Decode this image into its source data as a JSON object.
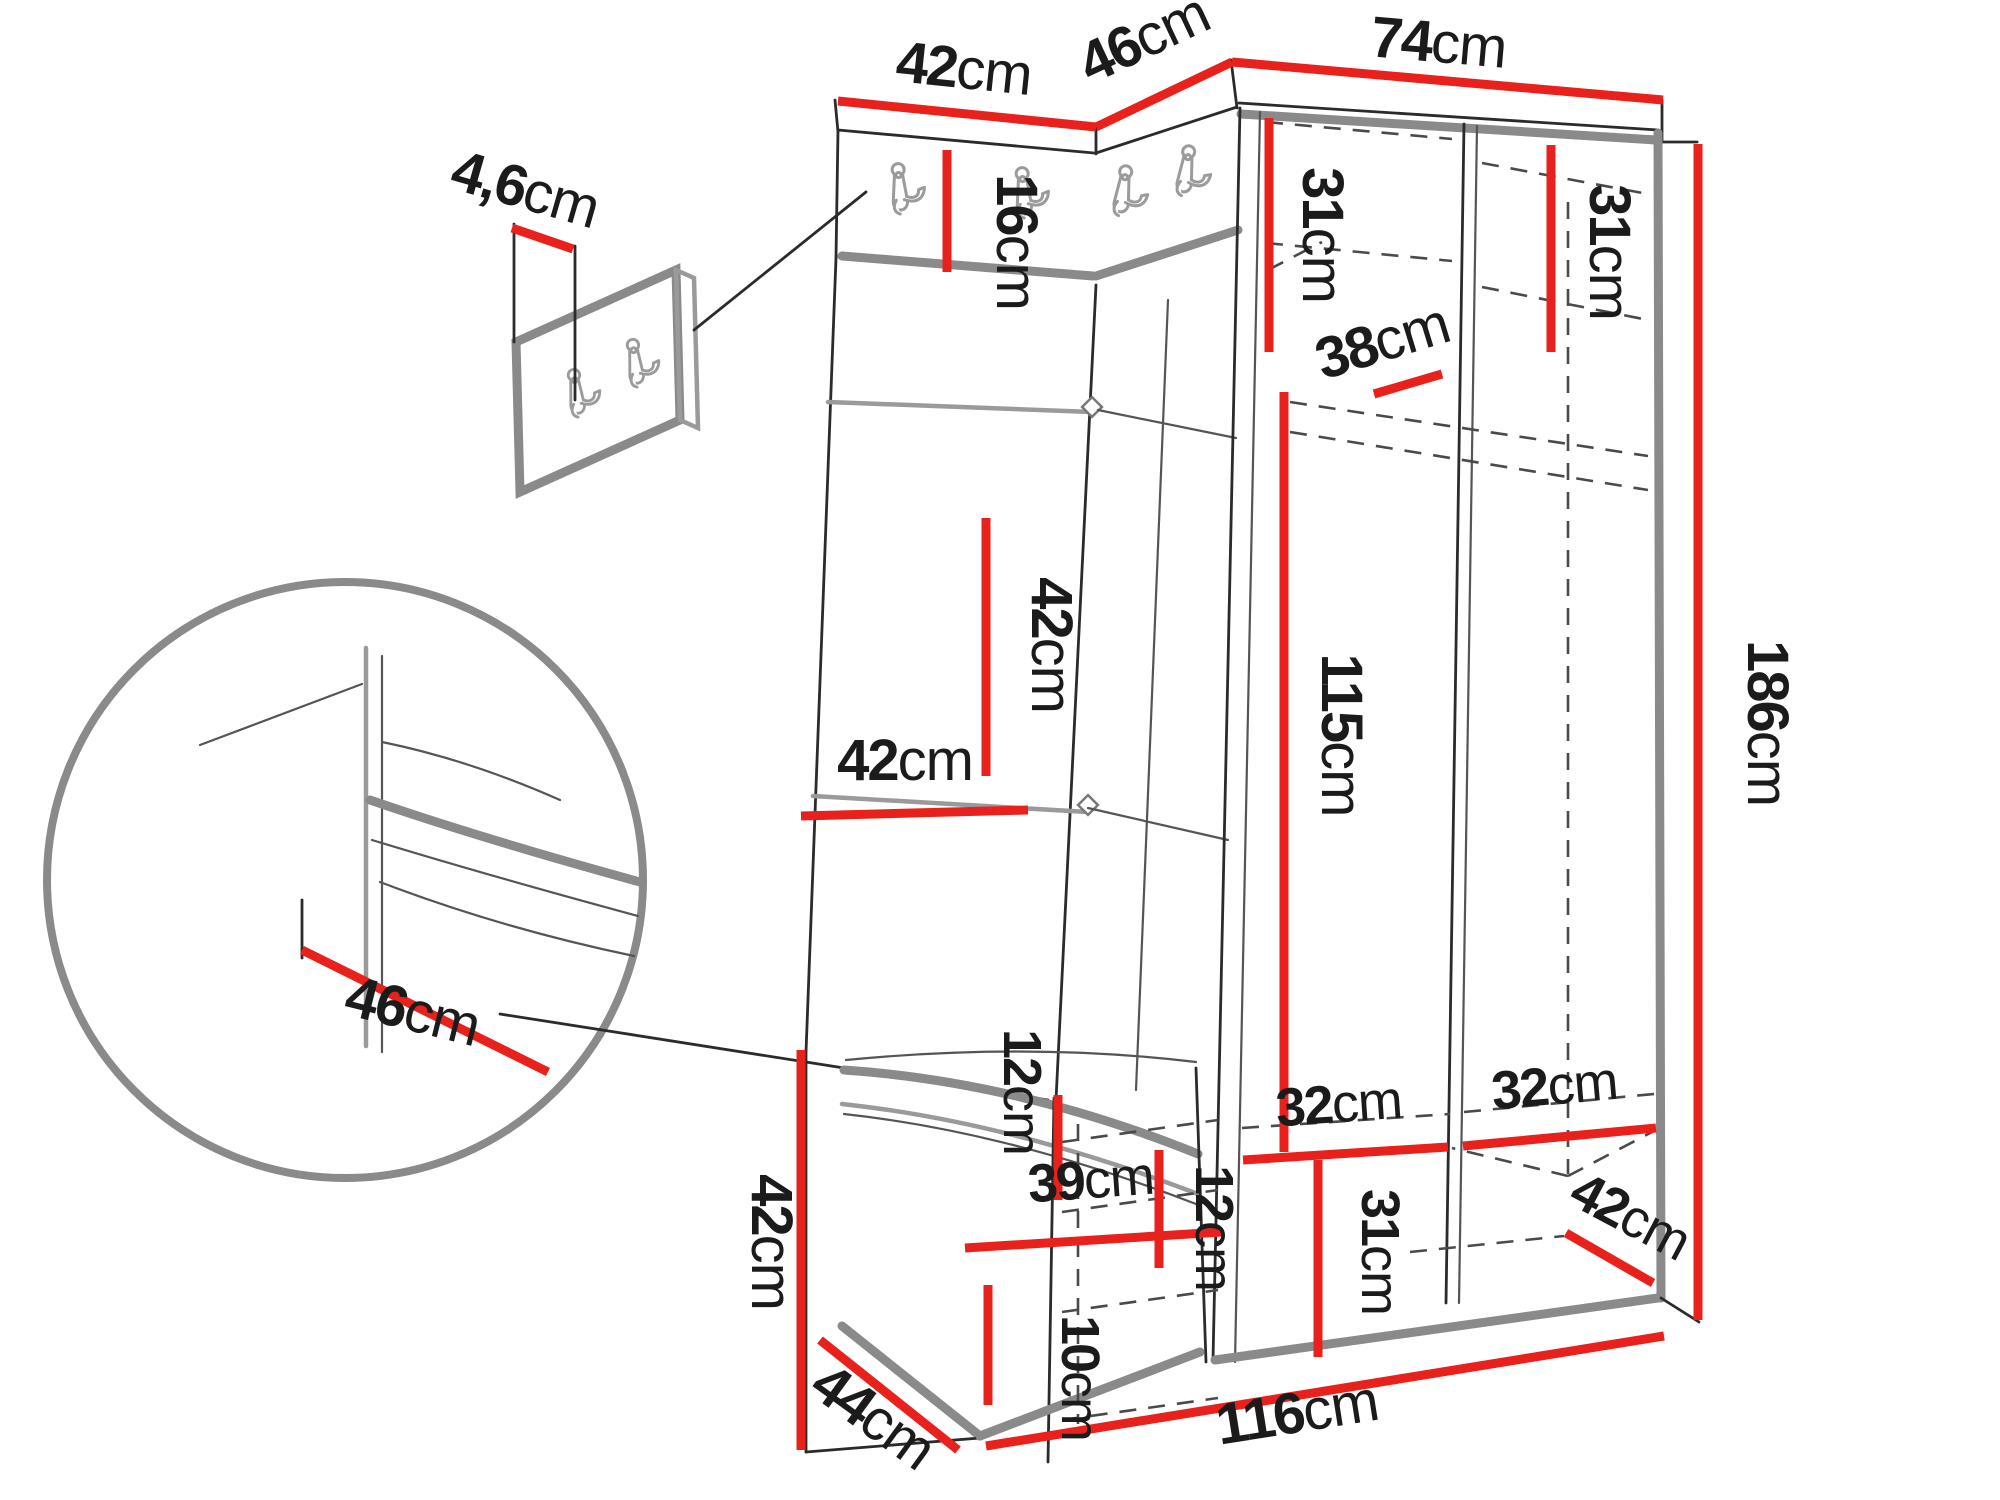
{
  "title": "Hallway corner wardrobe set dimension diagram",
  "units": "cm",
  "colors": {
    "dimension_line": "#e8211c",
    "outline": "#2b2b2b",
    "edge_gray": "#8a8a8a",
    "background": "#ffffff",
    "label_text": "#1b1b1b"
  },
  "icons": [
    "coat-hook-icon"
  ],
  "dims": {
    "top_left_width": {
      "v": "42",
      "u": "cm"
    },
    "top_corner_width": {
      "v": "46",
      "u": "cm"
    },
    "top_right_width": {
      "v": "74",
      "u": "cm"
    },
    "panel_thickness": {
      "v": "4,6",
      "u": "cm"
    },
    "hook_rail_height": {
      "v": "16",
      "u": "cm"
    },
    "shelf_left_top": {
      "v": "31",
      "u": "cm"
    },
    "shelf_right_top": {
      "v": "31",
      "u": "cm"
    },
    "rail_offset": {
      "v": "38",
      "u": "cm"
    },
    "panel_square_height": {
      "v": "42",
      "u": "cm"
    },
    "panel_square_width": {
      "v": "42",
      "u": "cm"
    },
    "hanging_space": {
      "v": "115",
      "u": "cm"
    },
    "total_height": {
      "v": "186",
      "u": "cm"
    },
    "seat_depth": {
      "v": "46",
      "u": "cm"
    },
    "bench_height": {
      "v": "42",
      "u": "cm"
    },
    "bench_top_clearance": {
      "v": "12",
      "u": "cm"
    },
    "bench_inner_width": {
      "v": "39",
      "u": "cm"
    },
    "bench_shelf_gap": {
      "v": "12",
      "u": "cm"
    },
    "bench_plinth_height": {
      "v": "10",
      "u": "cm"
    },
    "shelf_left_bottom": {
      "v": "32",
      "u": "cm"
    },
    "shelf_right_bottom": {
      "v": "32",
      "u": "cm"
    },
    "bottom_compartment": {
      "v": "31",
      "u": "cm"
    },
    "bottom_right_depth": {
      "v": "42",
      "u": "cm"
    },
    "bench_depth": {
      "v": "44",
      "u": "cm"
    },
    "total_width": {
      "v": "116",
      "u": "cm"
    }
  }
}
